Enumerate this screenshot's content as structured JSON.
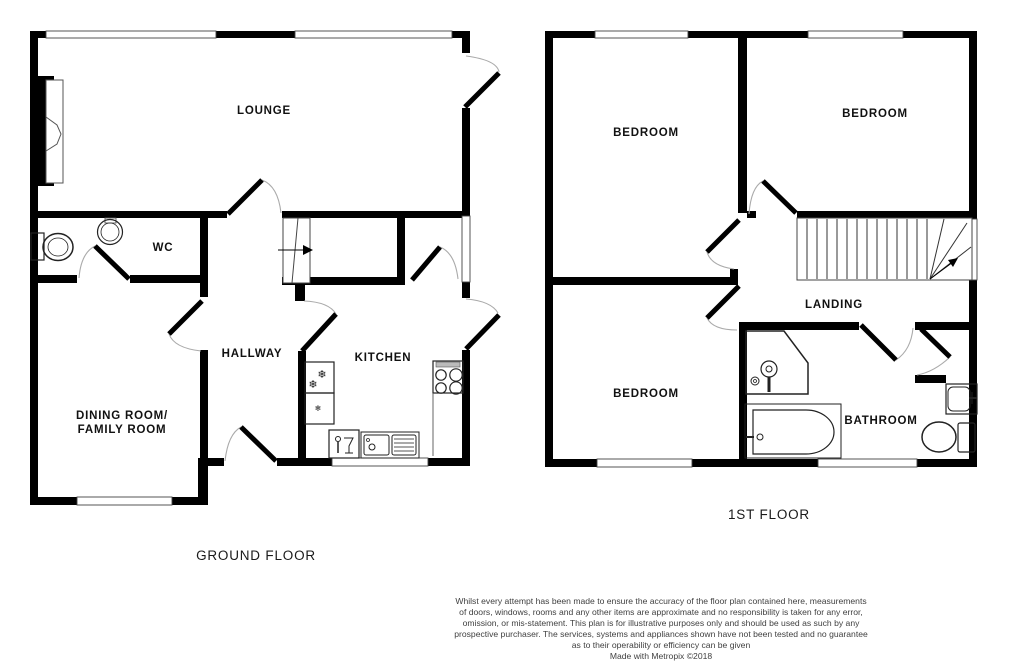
{
  "page": {
    "background": "#ffffff"
  },
  "colors": {
    "wall": "#000000",
    "door_swing_arc": "#aaaaaa",
    "window_outline": "#444444",
    "label_text": "#111111",
    "disclaimer_text": "#3f3f3f"
  },
  "icons": {
    "snowflake": "❄"
  },
  "ground_floor": {
    "title": "GROUND FLOOR",
    "rooms": {
      "lounge": "LOUNGE",
      "wc": "WC",
      "hallway": "HALLWAY",
      "kitchen": "KITCHEN",
      "dining_line1": "DINING ROOM/",
      "dining_line2": "FAMILY ROOM"
    },
    "fixtures": [
      "fireplace-icon",
      "toilet-icon",
      "basin-icon",
      "stairs-up-icon",
      "fridge-freezer-icon",
      "dishwasher-icon",
      "sink-drainer-icon",
      "hob-icon"
    ]
  },
  "first_floor": {
    "title": "1ST FLOOR",
    "rooms": {
      "bedroom_front_left": "BEDROOM",
      "bedroom_front_right": "BEDROOM",
      "bedroom_rear": "BEDROOM",
      "landing": "LANDING",
      "bathroom": "BATHROOM"
    },
    "fixtures": [
      "stairs-icon",
      "shower-icon",
      "bath-icon",
      "basin-icon",
      "toilet-icon"
    ]
  },
  "disclaimer": {
    "lines": [
      "Whilst every attempt has been made to ensure the accuracy of the floor plan contained here, measurements",
      "of doors, windows, rooms and any other items are approximate and no responsibility is taken for any error,",
      "omission, or mis-statement. This plan is for illustrative purposes only and should be used as such by any",
      "prospective purchaser. The services, systems and appliances shown have not been tested and no guarantee",
      "as to their operability or efficiency can be given"
    ],
    "credit": "Made with Metropix ©2018"
  }
}
